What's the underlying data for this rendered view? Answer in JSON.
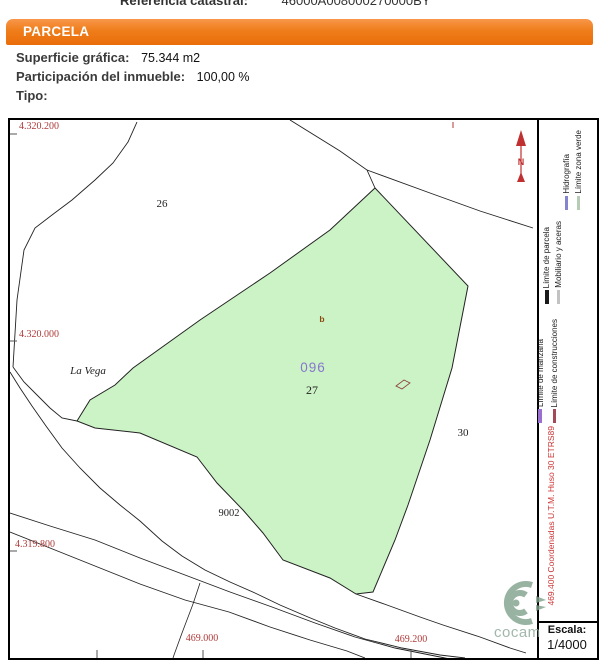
{
  "header": {
    "reference_label": "Referencia catastral:",
    "reference_value": "46000A008000270000BY",
    "section_title": "PARCELA",
    "fields": [
      {
        "label": "Superficie gráfica:",
        "value": "75.344 m2"
      },
      {
        "label": "Participación del inmueble:",
        "value": "100,00 %"
      },
      {
        "label": "Tipo:",
        "value": ""
      }
    ]
  },
  "map": {
    "place_name": "La Vega",
    "parcel_numbers": {
      "p26": "26",
      "p27": "27",
      "p30": "30",
      "p9002": "9002"
    },
    "subparcel_code": "096",
    "subparcel_letter": "b",
    "y_ticks": [
      "4.320.200",
      "4.320.000",
      "4.319.800"
    ],
    "x_ticks": [
      "469.000",
      "469.200"
    ],
    "north_label": "N",
    "parcel_fill_color": "#ccf3c6",
    "coordinate_text_color": "#b03a3a"
  },
  "legend": {
    "items": [
      {
        "label": "Hidrografía",
        "color": "#8585cf"
      },
      {
        "label": "Límite zona verde",
        "color": "#b7ccb4"
      },
      {
        "label": "Límite de parcela",
        "color": "#1a1a1a"
      },
      {
        "label": "Mobiliario y aceras",
        "color": "#c2c2c2"
      },
      {
        "label": "Límite de manzana",
        "color": "#9a6fd0"
      },
      {
        "label": "Límite de construcciones",
        "color": "#a04a5a"
      }
    ],
    "utm_note": "469.400 Coordenadas U.T.M. Huso 30 ETRS89",
    "scale_label": "Escala:",
    "scale_value": "1/4000"
  },
  "watermark": {
    "text": "cocam"
  },
  "colors": {
    "accent_orange": "#ef7d1a",
    "north_arrow_red": "#c03030"
  }
}
